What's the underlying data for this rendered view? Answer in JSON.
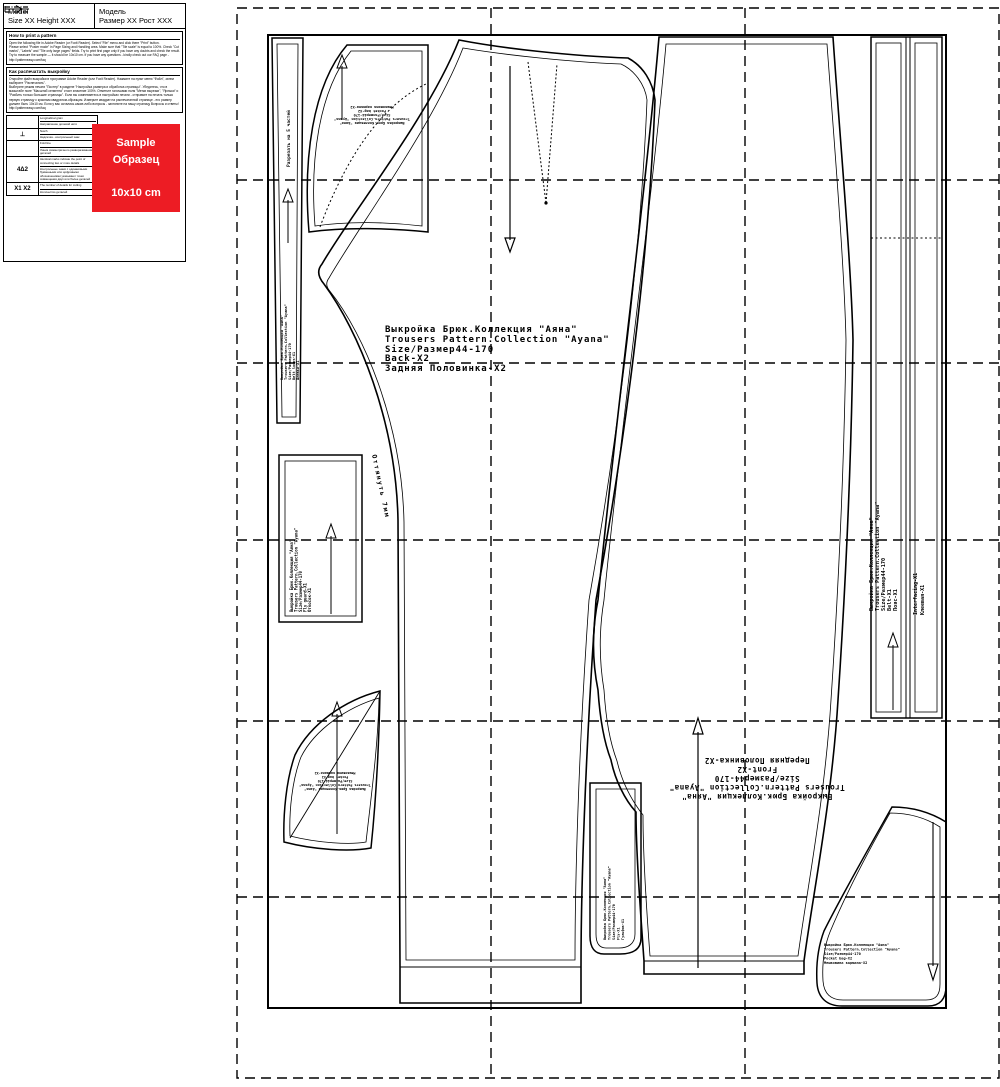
{
  "info_panel": {
    "model": {
      "en_label": "Model",
      "en_value": "Size XX Height XXX",
      "ru_label": "Модель",
      "ru_value": "Размер XX Рост XXX"
    },
    "print_en": {
      "title": "How to print a pattern",
      "body": "Open the following file in Adobe Reader (or Foxit Reader). Select \"File\" menu and click there \"Print\" button.\nPlease select \"Poster mode\" in Page Sizing and Handling area. Make sure that \"Tile scale\" is equal to 100%. Check \"Cut marks\", \"Labels\" and \"Tile only large pages\" fields. Try to print first page only if you have any doubts and check the result. Try to measure the sample — it should be 10x10 cm. If you have any questions - kindly check out our FAQ page - http://patterneasy.com/faq"
    },
    "print_ru": {
      "title": "Как распечатать выкройку",
      "body": "Откройте файл выкройки в программе Adobe Reader (или Foxit Reader). Нажмите на пункт меню \"Файл\", затем выберите \"Распечатать\".\nВыберите режим печати \"Постер\" в разделе \"Настройка размера и обработка страницы\". Убедитесь, что в масштабе поле \"Масштаб сегмента\" стоит значение 100%. Отметьте галочками поля \"Метки вырезки\", \"Ярлыки\" и \"Разбить только большие страницы\". Если вы сомневаетесь в настройках печати - отправьте на печать только первую страницу с красным квадратом-образцом. Измерьте квадрат на распечатанной странице - его размер должен быть 10х10 см. Если у вас остались какие-либо вопросы - загляните на нашу страницу Вопросы и ответы! http://patterneasy.com/faq"
    },
    "legend": {
      "rows": [
        {
          "symbol_text": "",
          "en": "Longitudinal grain",
          "ru": "Направление долевой нити"
        },
        {
          "symbol_text": "⊥",
          "en": "Notch",
          "ru": "Надсечка - контрольный знак"
        },
        {
          "symbol_text": "",
          "en": "Fold line",
          "ru": "Линия симметричного разворачивания деталей"
        },
        {
          "symbol_text": "4Δ2",
          "en": "Identical marks indicate the point of connecting two or more details",
          "ru": "Контрольные знаки с одинаковыми буквенными или цифровыми обозначениями указывают точки совмещения двух или более деталей"
        },
        {
          "symbol_text": "X1 X2",
          "en": "The number of details for cutting",
          "ru": "Количество деталей"
        }
      ]
    },
    "sample_square": {
      "line1": "Sample",
      "line2": "Образец",
      "line3": "10x10 cm",
      "color": "#ED1C24"
    }
  },
  "pattern": {
    "pieces": {
      "back": {
        "lines": [
          "Выкройка Брюк.Коллекция \"Аяна\"",
          "Trousers Pattern.Collection \"Ayana\"",
          "Size/Размер44-170",
          "Back-X2",
          "Задняя Половинка-Х2"
        ]
      },
      "front": {
        "lines": [
          "Выкройка Брюк.Коллекция \"Аяна\"",
          "Trousers Pattern.Collection \"Ayana\"",
          "Size/Размер44-170",
          "Front-X2",
          "Передняя Половинка-Х2"
        ]
      },
      "belt": {
        "lines": [
          "Выкройка Брюк.Коллекция \"Аяна\"",
          "Trousers Pattern.Collection \"Ayana\"",
          "Size/Размер44-170",
          "Belt-X1",
          "Пояс-Х1"
        ]
      },
      "interfacing": {
        "lines": [
          "Interfacing-X1",
          "Клеевая-Х1"
        ]
      },
      "belt_loops": {
        "lines": [
          "Выкройка Брюк.Коллекция \"Аяна\"",
          "Trousers Pattern.Collection \"Ayana\"",
          "Size/Размер44-170",
          "Belt loops-X1",
          "Шлёвки-Х1"
        ]
      },
      "fly": {
        "lines": [
          "Выкройка Брюк.Коллекция \"Аяна\"",
          "Trousers Pattern.Collection \"Ayana\"",
          "Size/Размер44-170",
          "Fly-X1",
          "Гульфик-Х1"
        ]
      },
      "fly_guard": {
        "lines": [
          "Выкройка Брюк.Коллекция \"Аяна\"",
          "Trousers Pattern.Collection \"Ayana\"",
          "Size/Размер44-170",
          "Fly guard-X1",
          "Откосок-Х1"
        ]
      },
      "pocket_top": {
        "lines": [
          "Выкройка Брюк.Коллекция \"Аяна\"",
          "Trousers Pattern.Collection \"Ayana\"",
          "Size/Размер44-170",
          "Pocket bag-X2",
          "Мешковина кармана-Х2"
        ]
      },
      "pocket_bottom_left": {
        "lines": [
          "Выкройка Брюк.Коллекция \"Аяна\"",
          "Trousers Pattern.Collection \"Ayana\"",
          "Size/Размер44-170",
          "Pocket bag-X2",
          "Мешковина кармана-Х2"
        ]
      },
      "pocket_bottom_right": {
        "lines": [
          "Выкройка Брюк.Коллекция \"Аяна\"",
          "Trousers Pattern.Collection \"Ayana\"",
          "Size/Размер44-170",
          "Pocket bag-X2",
          "Мешковина кармана-Х2"
        ]
      }
    },
    "notes": {
      "stretch": "Оттянуть 7мм",
      "cut_note": "Разрезать на 5 частей"
    }
  }
}
